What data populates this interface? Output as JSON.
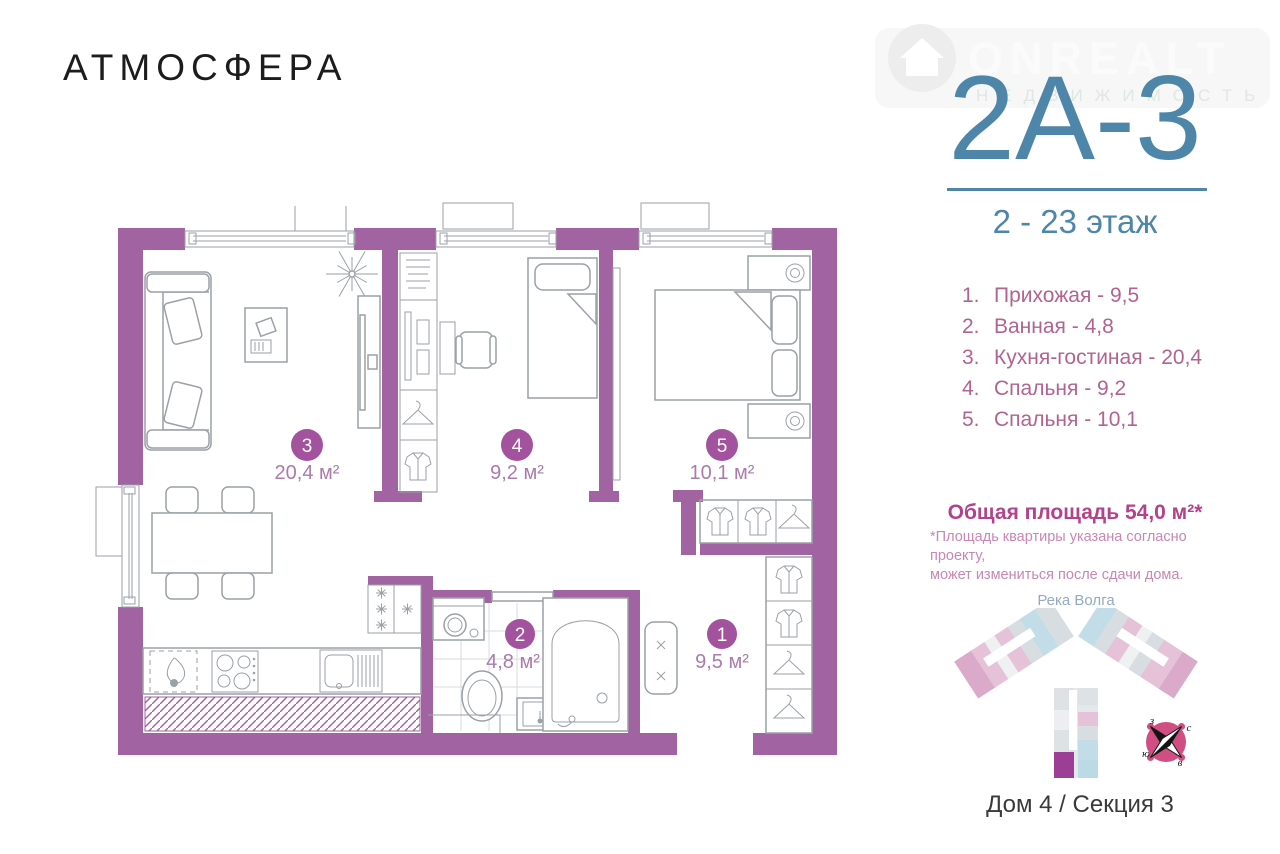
{
  "colors": {
    "wall": "#a263a2",
    "room_circle": "#a3529e",
    "area_label": "#aa7cab",
    "furniture": "#9aa1a7",
    "accent_blue": "#4d86a8",
    "list_pink": "#b16391",
    "total_pink": "#b3418c",
    "note_pink": "#c887b4",
    "river_blue": "#92abc2",
    "caption_dark": "#3a3a3a",
    "highlight_unit": "#9c3e96",
    "compass_pink": "#d14e82"
  },
  "brand": {
    "logo": "АТМОСФЕРА"
  },
  "watermark": {
    "line1": "ONREALT",
    "line2": "НЕДВИЖИМОСТЬ"
  },
  "unit": {
    "code": "2А-3",
    "floors": "2 - 23 этаж"
  },
  "rooms": [
    {
      "num": "1",
      "list_num": "1.",
      "name": "Прихожая",
      "list_text": "Прихожая - 9,5",
      "area_label": "9,5 м²"
    },
    {
      "num": "2",
      "list_num": "2.",
      "name": "Ванная",
      "list_text": "Ванная - 4,8",
      "area_label": "4,8 м²"
    },
    {
      "num": "3",
      "list_num": "3.",
      "name": "Кухня-гостиная",
      "list_text": "Кухня-гостиная - 20,4",
      "area_label": "20,4 м²"
    },
    {
      "num": "4",
      "list_num": "4.",
      "name": "Спальня",
      "list_text": "Спальня - 9,2",
      "area_label": "9,2 м²"
    },
    {
      "num": "5",
      "list_num": "5.",
      "name": "Спальня",
      "list_text": "Спальня - 10,1",
      "area_label": "10,1 м²"
    }
  ],
  "total": {
    "title": "Общая площадь 54,0 м²*",
    "note1": "*Площадь квартиры указана согласно проекту,",
    "note2": "может измениться после сдачи дома."
  },
  "site": {
    "river": "Река Волга",
    "caption": "Дом 4 / Секция 3",
    "compass": {
      "n": "с",
      "e": "в",
      "s": "ю",
      "w": "з"
    }
  }
}
